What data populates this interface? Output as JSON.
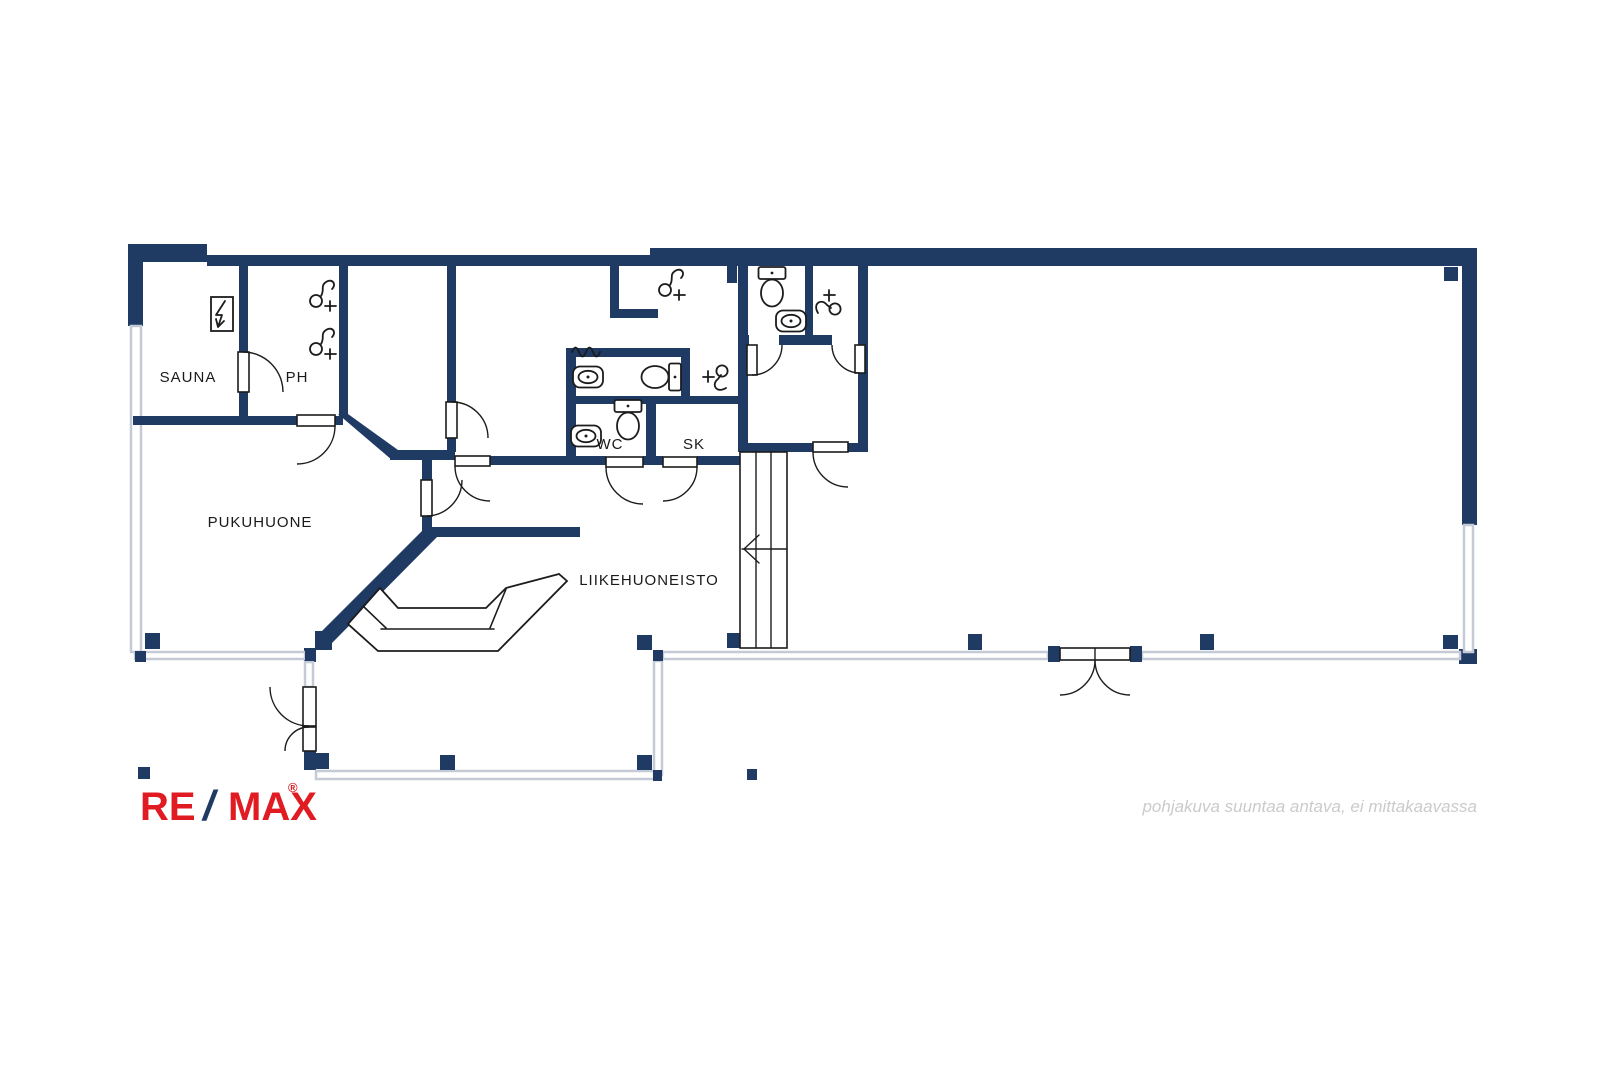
{
  "window": {
    "width": 1600,
    "height": 1067,
    "background": "#ffffff",
    "content_type": "real-estate floor plan"
  },
  "branding": {
    "logo": {
      "re": "RE",
      "slash": "/",
      "max": "MAX",
      "registered": "®"
    }
  },
  "footer": {
    "disclaimer": "pohjakuva suuntaa antava, ei mittakaavassa"
  },
  "colors": {
    "wall": "#1f3a63",
    "glass": "#c4cbd6",
    "fixture": "#1c1c1c",
    "label": "#1a1a1a",
    "muted": "#cbcbcb",
    "red": "#e11b22"
  },
  "rooms": {
    "sauna": {
      "label": "SAUNA"
    },
    "ph": {
      "label": "PH"
    },
    "pukuhuone": {
      "label": "PUKUHUONE"
    },
    "wc": {
      "label": "WC"
    },
    "sk": {
      "label": "SK"
    },
    "liikehuoneisto": {
      "label": "LIIKEHUONEISTO"
    }
  },
  "fixtures": {
    "sauna_stove": 1,
    "shower_heads": 3,
    "toilets": 3,
    "washbasins": 3,
    "faucets": 2,
    "towel_radiator": 1,
    "staircase": 1,
    "reception_counter": 1,
    "double_doors": 2,
    "single_doors": 10,
    "columns": 15
  }
}
